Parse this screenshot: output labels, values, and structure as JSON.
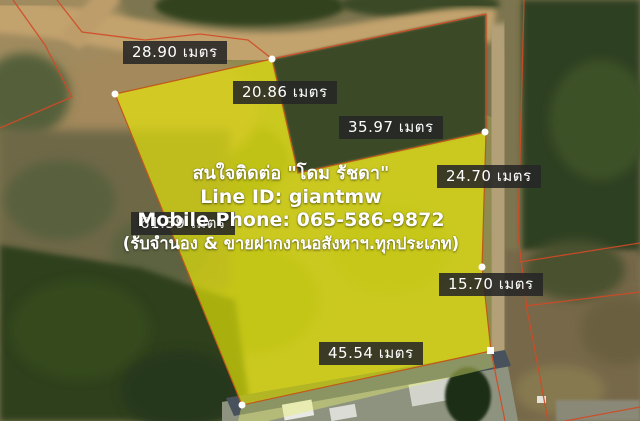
{
  "map": {
    "type": "aerial-land-plot-listing",
    "colors": {
      "plot_highlight": "#e8e400",
      "boundary_line": "#d24a26",
      "label_background": "#262626",
      "label_text": "#ffffff",
      "contact_text": "#ffffff"
    },
    "measurements": [
      {
        "id": "top-edge",
        "label": "28.90 เมตร"
      },
      {
        "id": "upper-right-edge",
        "label": "20.86 เมตร"
      },
      {
        "id": "wedge-top-edge",
        "label": "35.97 เมตร"
      },
      {
        "id": "right-upper-edge",
        "label": "24.70 เมตร"
      },
      {
        "id": "right-lower-edge",
        "label": "15.70 เมตร"
      },
      {
        "id": "bottom-edge",
        "label": "45.54 เมตร"
      },
      {
        "id": "left-edge",
        "label": "61.39 เมตร"
      }
    ],
    "contact": {
      "line1": "สนใจติดต่อ \"โดม รัชดา\"",
      "line2": "Line ID: giantmw",
      "line3": "Mobile Phone: 065-586-9872",
      "line4": "(รับจำนอง & ขายฝากงานอสังหาฯ.ทุกประเภท)"
    }
  }
}
